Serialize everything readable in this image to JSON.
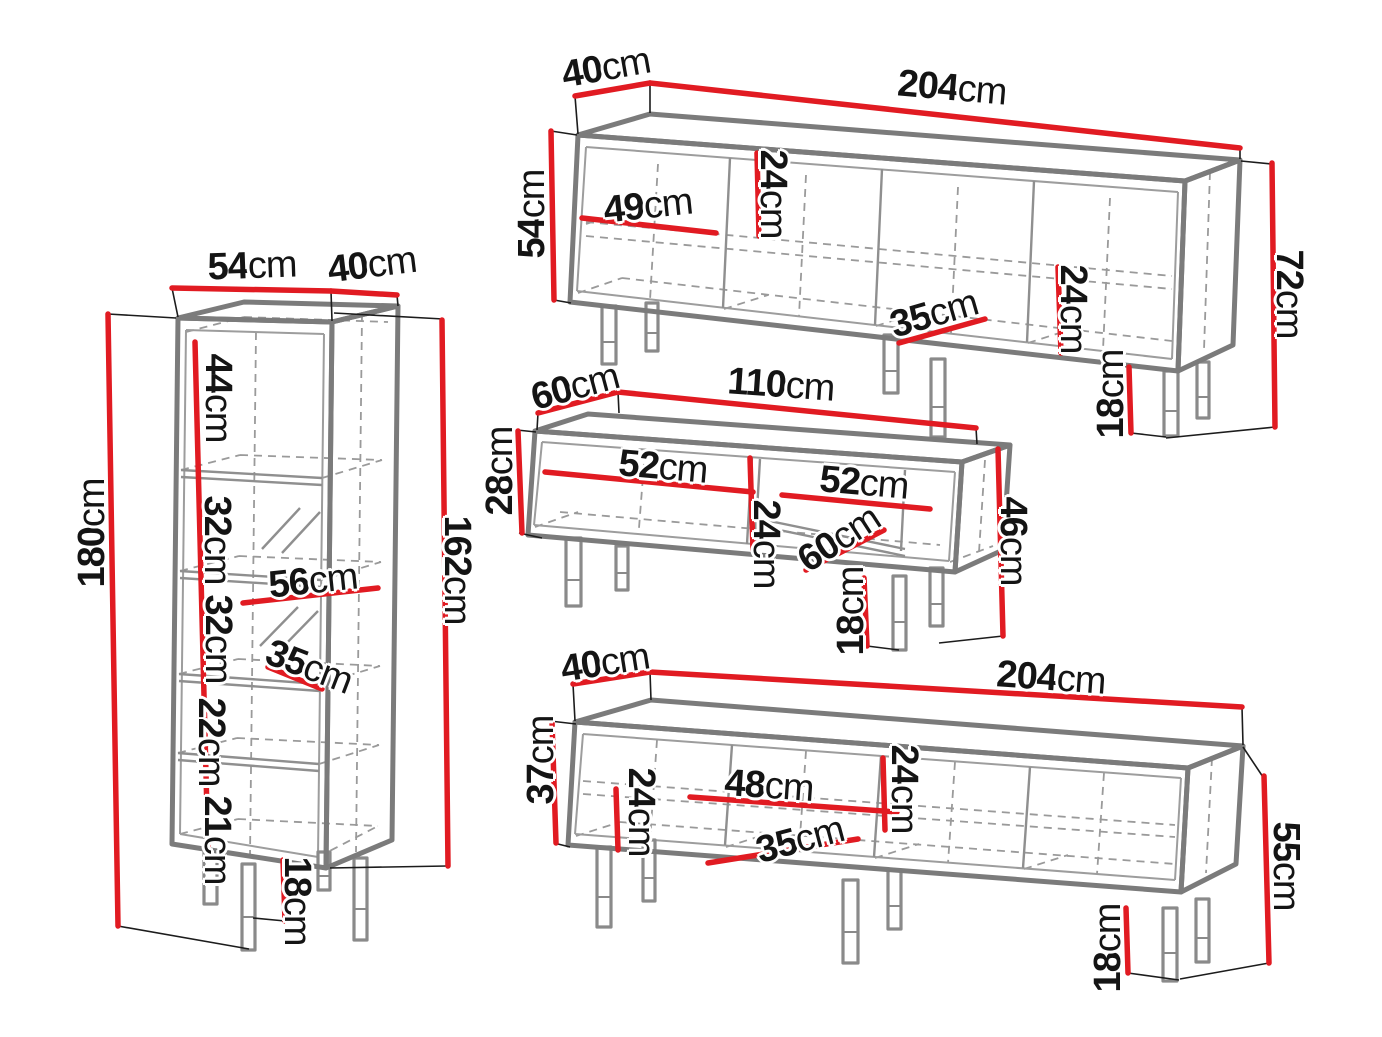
{
  "colors": {
    "background": "#ffffff",
    "dimension_red": "#e11b22",
    "outline_gray": "#7b7b7b",
    "text_black": "#141414"
  },
  "units": [
    {
      "id": "tall-display-cabinet",
      "labels": [
        {
          "value": "54",
          "unit": "cm"
        },
        {
          "value": "40",
          "unit": "cm"
        },
        {
          "value": "180",
          "unit": "cm"
        },
        {
          "value": "44",
          "unit": "cm"
        },
        {
          "value": "32",
          "unit": "cm"
        },
        {
          "value": "56",
          "unit": "cm"
        },
        {
          "value": "32",
          "unit": "cm"
        },
        {
          "value": "35",
          "unit": "cm"
        },
        {
          "value": "22",
          "unit": "cm"
        },
        {
          "value": "21",
          "unit": "cm"
        },
        {
          "value": "162",
          "unit": "cm"
        },
        {
          "value": "18",
          "unit": "cm"
        }
      ]
    },
    {
      "id": "large-sideboard-top",
      "labels": [
        {
          "value": "40",
          "unit": "cm"
        },
        {
          "value": "204",
          "unit": "cm"
        },
        {
          "value": "54",
          "unit": "cm"
        },
        {
          "value": "49",
          "unit": "cm"
        },
        {
          "value": "24",
          "unit": "cm"
        },
        {
          "value": "35",
          "unit": "cm"
        },
        {
          "value": "24",
          "unit": "cm"
        },
        {
          "value": "72",
          "unit": "cm"
        },
        {
          "value": "18",
          "unit": "cm"
        }
      ]
    },
    {
      "id": "tv-stand",
      "labels": [
        {
          "value": "60",
          "unit": "cm"
        },
        {
          "value": "110",
          "unit": "cm"
        },
        {
          "value": "28",
          "unit": "cm"
        },
        {
          "value": "52",
          "unit": "cm"
        },
        {
          "value": "52",
          "unit": "cm"
        },
        {
          "value": "24",
          "unit": "cm"
        },
        {
          "value": "60",
          "unit": "cm"
        },
        {
          "value": "46",
          "unit": "cm"
        },
        {
          "value": "18",
          "unit": "cm"
        }
      ]
    },
    {
      "id": "low-sideboard-bottom",
      "labels": [
        {
          "value": "40",
          "unit": "cm"
        },
        {
          "value": "204",
          "unit": "cm"
        },
        {
          "value": "37",
          "unit": "cm"
        },
        {
          "value": "24",
          "unit": "cm"
        },
        {
          "value": "48",
          "unit": "cm"
        },
        {
          "value": "24",
          "unit": "cm"
        },
        {
          "value": "35",
          "unit": "cm"
        },
        {
          "value": "55",
          "unit": "cm"
        },
        {
          "value": "18",
          "unit": "cm"
        }
      ]
    }
  ]
}
